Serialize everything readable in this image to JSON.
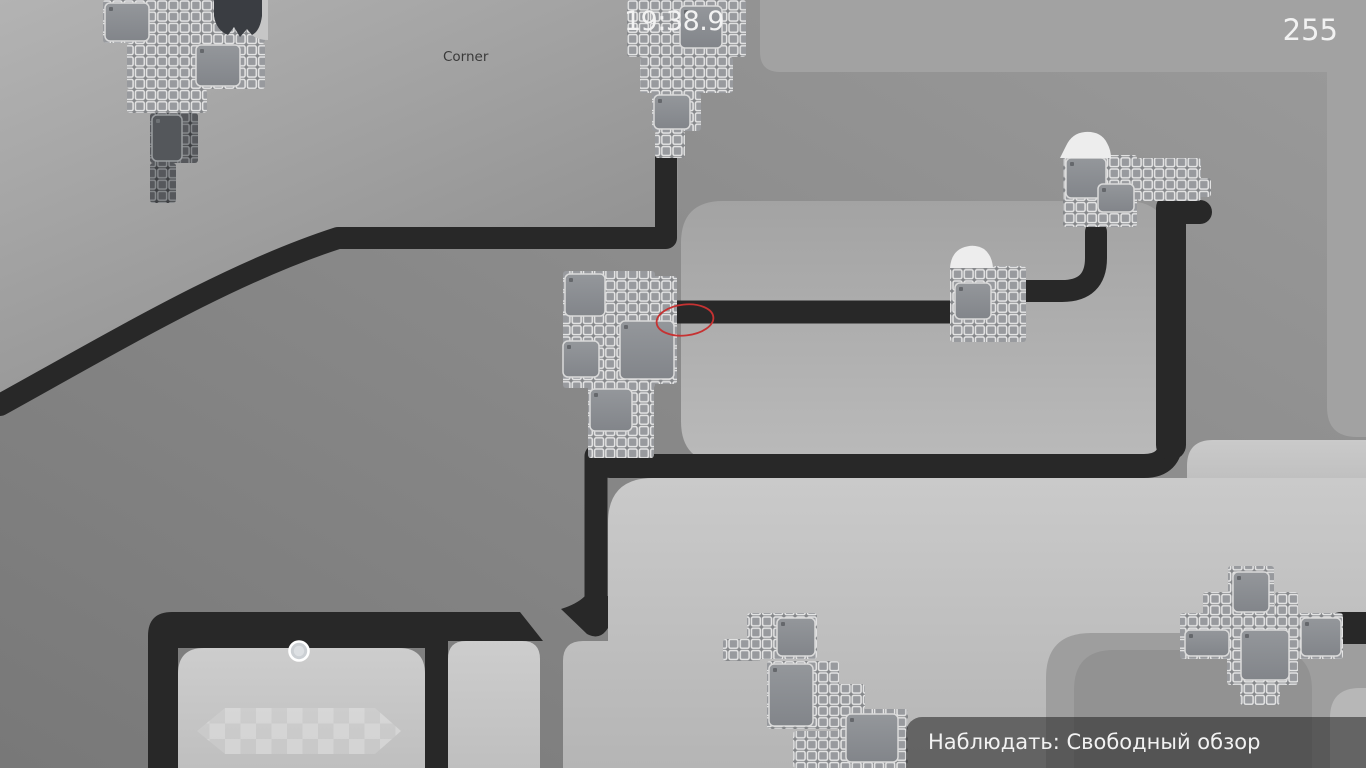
{
  "hud": {
    "timer": "19:38.9",
    "score": "255",
    "map_label": "Corner",
    "spectate": {
      "label": "Наблюдать: Свободный обзор"
    }
  },
  "colors": {
    "black_path": "#282828",
    "base_from": "#9b9b9b",
    "base_to": "#787878",
    "region_a_from": "#b3b3b3",
    "region_a_to": "#8c8c8c",
    "top_band": "#a2a2a2",
    "room_from": "#a3a3a3",
    "room_to": "#bababa",
    "d_from": "#cacaca",
    "d_to": "#b5b5b5",
    "room_inner_from": "#cdcdcd",
    "room_inner_to": "#bfbfbf",
    "blob1": "#9e9e9e",
    "blob2": "#929292",
    "blob3": "#b7b7b7",
    "tile_light_bg": "#85878a",
    "tile_light_fill": "#989a9e",
    "tile_light_stroke": "#e6e6e6",
    "tile_dark_bg": "#3e4043",
    "tile_dark_fill": "#56585c",
    "tile_dark_stroke": "#888b8e",
    "panel_from": "#94979b",
    "panel_to": "#82858a",
    "panel_stroke": "#dadada",
    "panel_dark_fill": "#54575b",
    "panel_dark_stroke": "#9a9da0",
    "snow": "#ededed",
    "spike_blob": "#3a3d42",
    "blob_back": "#c6c6c6",
    "red_ellipse": "#c63232",
    "pickup_ring": "#ffffff",
    "pickup_fill": "#ccd0d4",
    "pickup_core": "#dde0e3",
    "checker_base": "rgba(255,255,255,0.13)",
    "checker_cell": "#ffffff"
  },
  "scene": {
    "fills": [
      {
        "name": "region-top-left",
        "d": "M0,0 H678 V230 H334 C226,277 114,344 0,414 Z",
        "fill": "aGrad"
      },
      {
        "name": "top-band",
        "d": "M760,0 V52 Q760,72 780,72 H1366 V0 Z",
        "fill": "#a2a2a2"
      },
      {
        "name": "right-column",
        "d": "M1327,70 V407 Q1327,437 1357,437 H1366 V70 Z",
        "fill": "#a2a2a2"
      },
      {
        "name": "light-room",
        "d": "M723,201 H1126 Q1168,201 1168,243 V421 Q1168,463 1126,463 H723 Q681,463 681,421 V243 Q681,201 723,201 Z",
        "fill": "roomGrad"
      },
      {
        "name": "region-d-step",
        "d": "M1187,466 Q1187,440 1213,440 H1366 V520 H1187 Z",
        "fill": "dGrad"
      },
      {
        "name": "region-d",
        "d": "M563,768 V661 Q563,641 583,641 H608 V523 Q608,478 653,478 H1366 V768 Z",
        "fill": "dGrad"
      },
      {
        "name": "blob-right",
        "d": "M1046,678 Q1046,633 1091,633 H1366 V768 H1046 Z",
        "fill": "#9e9e9e"
      },
      {
        "name": "blob-right-inner",
        "d": "M1074,690 Q1074,650 1114,650 H1272 Q1312,650 1312,690 V768 H1074 Z",
        "fill": "#929292"
      },
      {
        "name": "blob-corner",
        "d": "M1330,718 Q1330,688 1360,688 H1366 V768 H1330 Z",
        "fill": "#b7b7b7"
      }
    ],
    "strokes": [
      {
        "name": "path-top-left",
        "d": "M0,405 C128,334 233,272 338,238 L666,238 L666,148",
        "w": 22
      },
      {
        "name": "path-mid-left",
        "d": "M656,312 H958",
        "w": 23
      },
      {
        "name": "path-mid-right",
        "d": "M1010,291 H1062 Q1096,291 1096,258 V232",
        "w": 22
      },
      {
        "name": "path-lower",
        "d": "M610,466 H1144 Q1171,466 1171,439 V212 H1200",
        "w": 24
      },
      {
        "name": "path-vertical-right",
        "d": "M1171,208 V445",
        "w": 30
      },
      {
        "name": "path-vertical-center",
        "d": "M596,456 V620",
        "w": 23
      }
    ],
    "blacks": [
      {
        "name": "path-center-foot",
        "d": "M585,596 H608 V628 Q600,641 587,634 L561,609 Q577,604 585,596 Z"
      },
      {
        "name": "rooms-structure",
        "d": "M148,636 Q148,612 172,612 L520,612 L543,641 L448,641 L448,768 L425,768 L425,648 L178,648 L178,768 L148,768 Z"
      },
      {
        "name": "path-right-stub",
        "d": "M1366,612 H1342 Q1327,612 1327,628 Q1327,644 1342,644 H1366 Z"
      }
    ],
    "rooms": [
      {
        "name": "room-left",
        "d": "M178,674 Q178,648 204,648 H399 Q425,648 425,674 V768 H178 Z"
      },
      {
        "name": "room-small",
        "d": "M448,659 Q448,641 466,641 H522 Q540,641 540,659 V768 H448 Z"
      }
    ],
    "structures": [
      {
        "name": "structure-top-left",
        "variant": "light",
        "rects": [
          [
            103,
            0,
            162,
            43
          ],
          [
            127,
            43,
            138,
            46
          ],
          [
            127,
            89,
            80,
            24
          ]
        ],
        "panels": [
          [
            105,
            3,
            44,
            38
          ],
          [
            196,
            45,
            44,
            41
          ]
        ]
      },
      {
        "name": "structure-top-left-dark",
        "variant": "dark",
        "rects": [
          [
            150,
            113,
            48,
            50
          ],
          [
            150,
            163,
            26,
            40
          ]
        ],
        "panels": [
          [
            152,
            115,
            30,
            46
          ]
        ]
      },
      {
        "name": "structure-top-center",
        "variant": "light",
        "rects": [
          [
            627,
            0,
            119,
            57
          ],
          [
            640,
            57,
            93,
            36
          ],
          [
            652,
            93,
            49,
            38
          ],
          [
            655,
            131,
            30,
            27
          ]
        ],
        "panels": [
          [
            680,
            6,
            42,
            42
          ],
          [
            654,
            95,
            36,
            34
          ]
        ]
      },
      {
        "name": "structure-right-snow",
        "variant": "light",
        "rects": [
          [
            1063,
            155,
            74,
            72
          ],
          [
            1137,
            158,
            64,
            43
          ],
          [
            1192,
            178,
            19,
            19
          ]
        ],
        "panels": [
          [
            1066,
            158,
            40,
            40
          ],
          [
            1098,
            184,
            36,
            28
          ]
        ]
      },
      {
        "name": "structure-center",
        "variant": "light",
        "rects": [
          [
            563,
            271,
            92,
            117
          ],
          [
            627,
            276,
            50,
            108
          ],
          [
            588,
            384,
            66,
            74
          ],
          [
            655,
            318,
            22,
            24
          ]
        ],
        "panels": [
          [
            565,
            274,
            40,
            42
          ],
          [
            563,
            341,
            36,
            36
          ],
          [
            620,
            321,
            54,
            58
          ],
          [
            590,
            389,
            42,
            42
          ]
        ]
      },
      {
        "name": "structure-snow-block",
        "variant": "light",
        "rects": [
          [
            950,
            266,
            76,
            76
          ]
        ],
        "panels": [
          [
            955,
            283,
            36,
            36
          ]
        ]
      },
      {
        "name": "structure-bottom-center",
        "variant": "light",
        "rects": [
          [
            747,
            613,
            70,
            46
          ],
          [
            723,
            639,
            38,
            22
          ],
          [
            767,
            661,
            72,
            68
          ],
          [
            837,
            684,
            28,
            26
          ],
          [
            838,
            709,
            70,
            59
          ],
          [
            793,
            731,
            48,
            37
          ]
        ],
        "panels": [
          [
            777,
            618,
            38,
            38
          ],
          [
            769,
            664,
            44,
            62
          ],
          [
            846,
            714,
            52,
            48
          ]
        ]
      },
      {
        "name": "structure-bottom-right",
        "variant": "light",
        "rects": [
          [
            1228,
            566,
            46,
            52
          ],
          [
            1203,
            592,
            32,
            36
          ],
          [
            1275,
            592,
            23,
            24
          ],
          [
            1180,
            613,
            52,
            46
          ],
          [
            1227,
            615,
            71,
            70
          ],
          [
            1297,
            613,
            46,
            46
          ],
          [
            1240,
            683,
            40,
            22
          ]
        ],
        "panels": [
          [
            1233,
            572,
            36,
            40
          ],
          [
            1185,
            630,
            44,
            26
          ],
          [
            1241,
            630,
            48,
            50
          ],
          [
            1301,
            618,
            40,
            38
          ]
        ]
      }
    ],
    "snow": [
      {
        "name": "snow-drift-right",
        "d": "M1060,158 L1066,146 Q1072,133 1085,132 Q1101,131 1107,143 Q1111,150 1111,158 Z"
      },
      {
        "name": "snow-drift-center",
        "d": "M950,268 Q951,253 962,248 Q974,243 984,249 Q992,255 993,268 Z"
      }
    ],
    "spike": {
      "back": "M240,0 Q240,40 268,40 L268,0 Z",
      "blob": "M214,0 V16 Q216,30 228,35 L234,27 L240,37 L247,29 L252,35 Q260,31 262,16 V0 Z"
    },
    "entities": {
      "pickup": {
        "cx": 299,
        "cy": 651,
        "r": 9.5
      },
      "checker": {
        "hex": "M197,731 L225,708 H375 L401,731 L375,754 H225 Z",
        "cell": 15.5,
        "x": 225,
        "y": 708
      },
      "red_ellipse": {
        "cx": 685,
        "cy": 320,
        "rx": 28.5,
        "ry": 15.5,
        "rot": -6
      }
    }
  }
}
